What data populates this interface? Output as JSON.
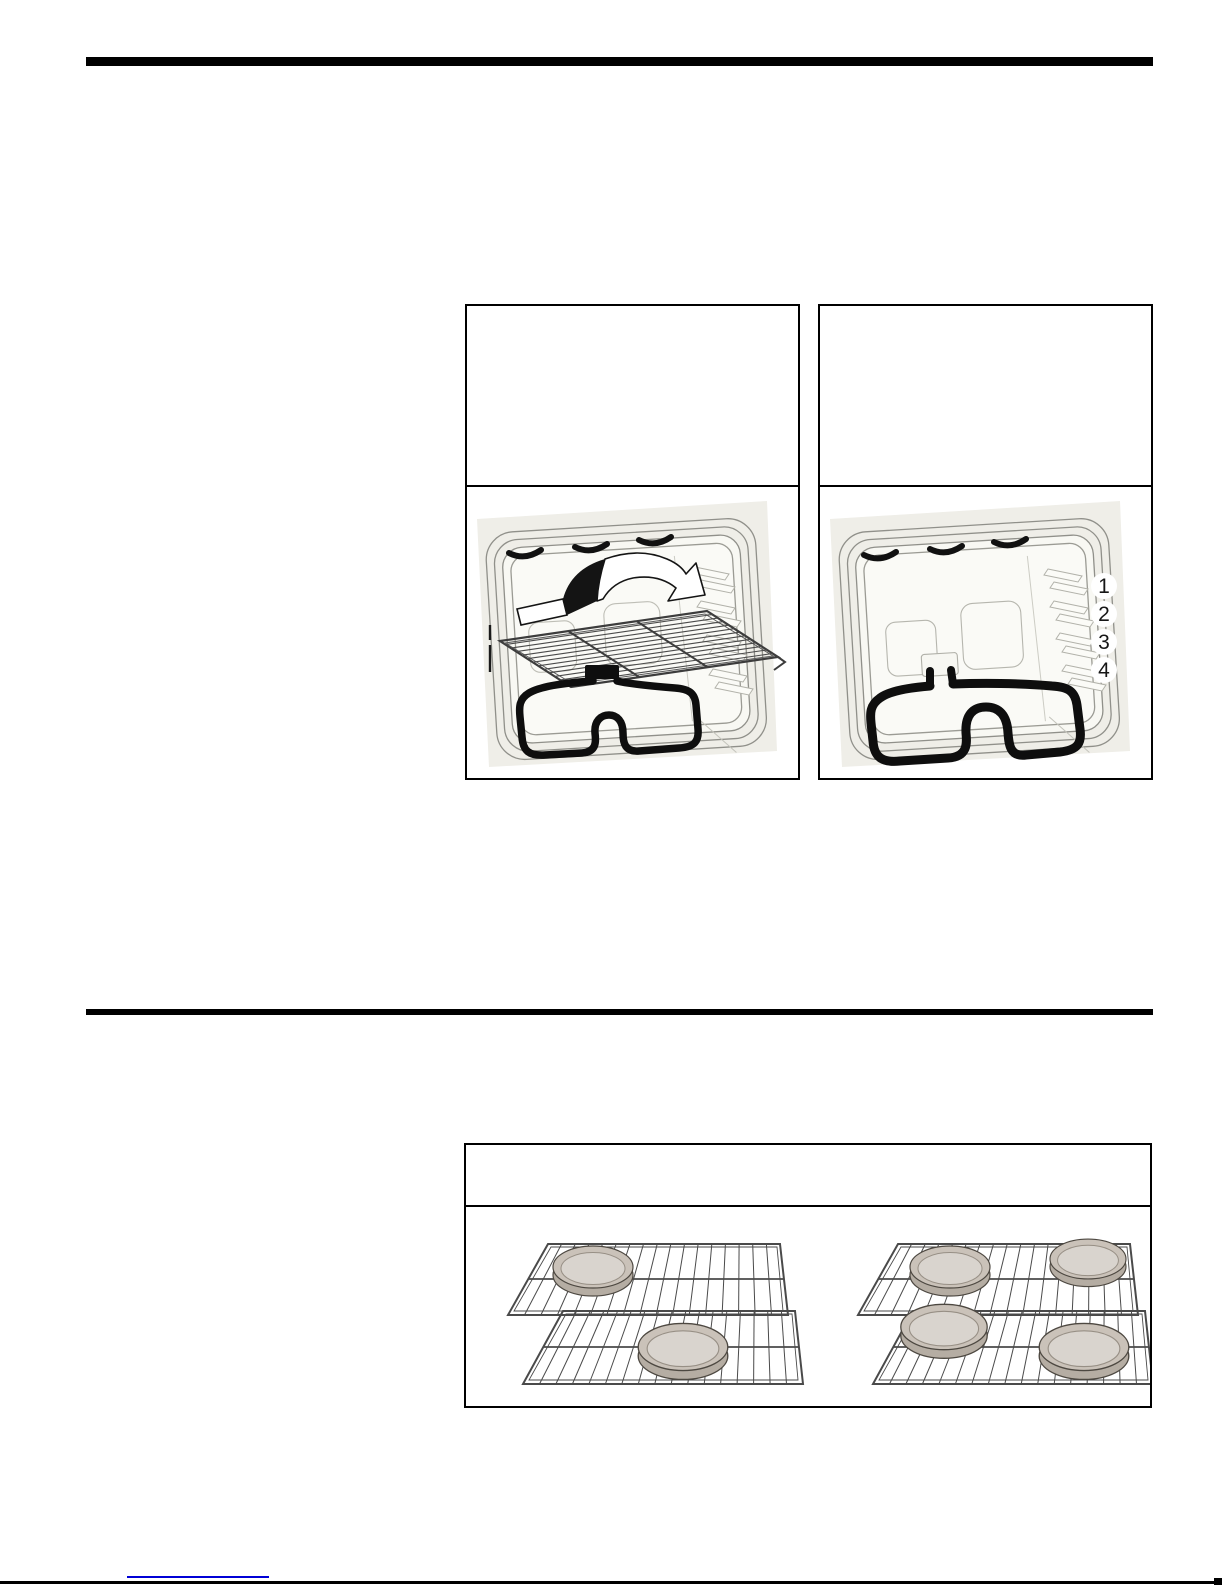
{
  "page": {
    "background": "#ffffff",
    "width": 1225,
    "height": 1585
  },
  "figures": {
    "rack_positions": [
      "1",
      "2",
      "3",
      "4"
    ]
  },
  "colors": {
    "section_rule": "#000000",
    "figure_border": "#000000",
    "oven_panel": "#efeee8",
    "frame_outline": "#90908a",
    "support_outline": "#b2b2aa",
    "bake_element": "#0e0e0e",
    "rack_wire": "#4a4a4a",
    "pan_rim": "#b5ada3",
    "pan_face": "#cac2b9",
    "pan_inner": "#d9d4ce",
    "link_underline_blue": "#0000d6",
    "page_edge_line": "#000000"
  }
}
